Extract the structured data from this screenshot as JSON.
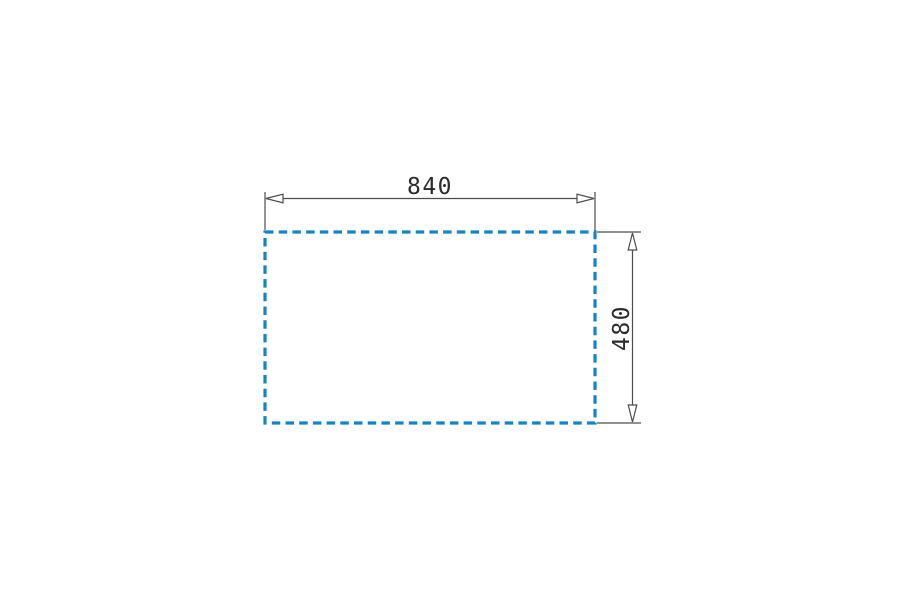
{
  "drawing": {
    "type": "technical-dimension-diagram",
    "shape": "dashed-rectangle",
    "width_dimension": {
      "label": "840",
      "value": 840
    },
    "height_dimension": {
      "label": "480",
      "value": 480
    },
    "colors": {
      "outline": "#1583c8",
      "dimension_lines": "#4d4d4d",
      "arrowhead_fill": "#ffffff",
      "text": "#2b2b2b",
      "background": "#ffffff"
    }
  }
}
